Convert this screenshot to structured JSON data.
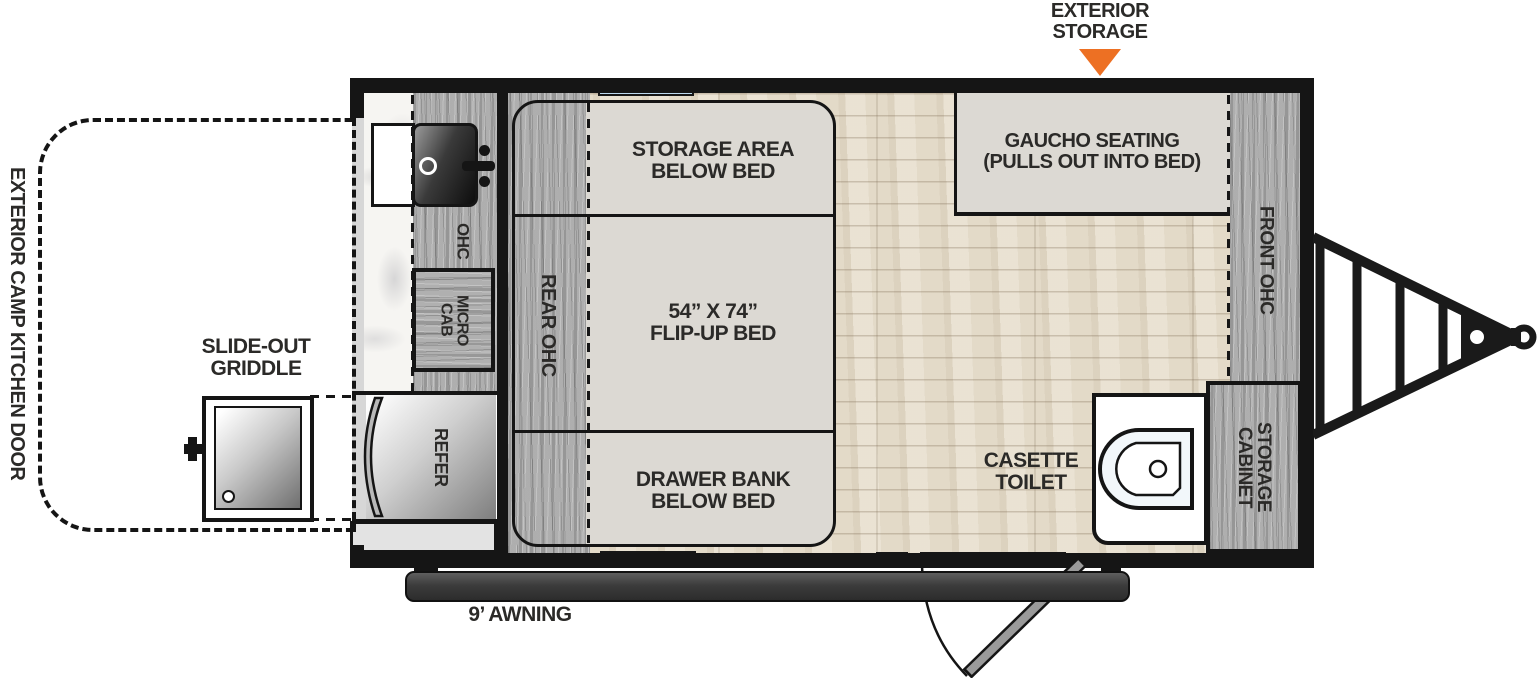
{
  "labels": {
    "exterior_storage": "EXTERIOR\nSTORAGE",
    "gaucho_seating": "GAUCHO SEATING\n(PULLS OUT INTO BED)",
    "front_ohc": "FRONT OHC",
    "storage_area_below_bed": "STORAGE AREA\nBELOW BED",
    "flip_up_bed": "54” X 74”\nFLIP-UP BED",
    "drawer_bank_below_bed": "DRAWER BANK\nBELOW BED",
    "rear_ohc": "REAR OHC",
    "ohc": "OHC",
    "micro_cab": "MICRO\nCAB",
    "refer": "REFER",
    "slide_out_griddle": "SLIDE-OUT\nGRIDDLE",
    "exterior_camp_kitchen_door": "EXTERIOR CAMP KITCHEN DOOR",
    "casette_toilet": "CASETTE\nTOILET",
    "storage_cabinet": "STORAGE\nCABINET",
    "awning": "9’ AWNING"
  },
  "colors": {
    "accent_orange": "#ED7023",
    "window_blue": "#BCD8EE",
    "label_dark": "#2B2A28",
    "wall_black": "#151515"
  },
  "icons": {
    "exterior_storage_marker": "down-triangle-icon",
    "sink": "kitchen-sink-icon",
    "toilet": "cassette-toilet-icon",
    "griddle": "griddle-icon",
    "hitch": "trailer-tongue-hitch-icon",
    "entry_door": "entry-door-swing-icon"
  }
}
